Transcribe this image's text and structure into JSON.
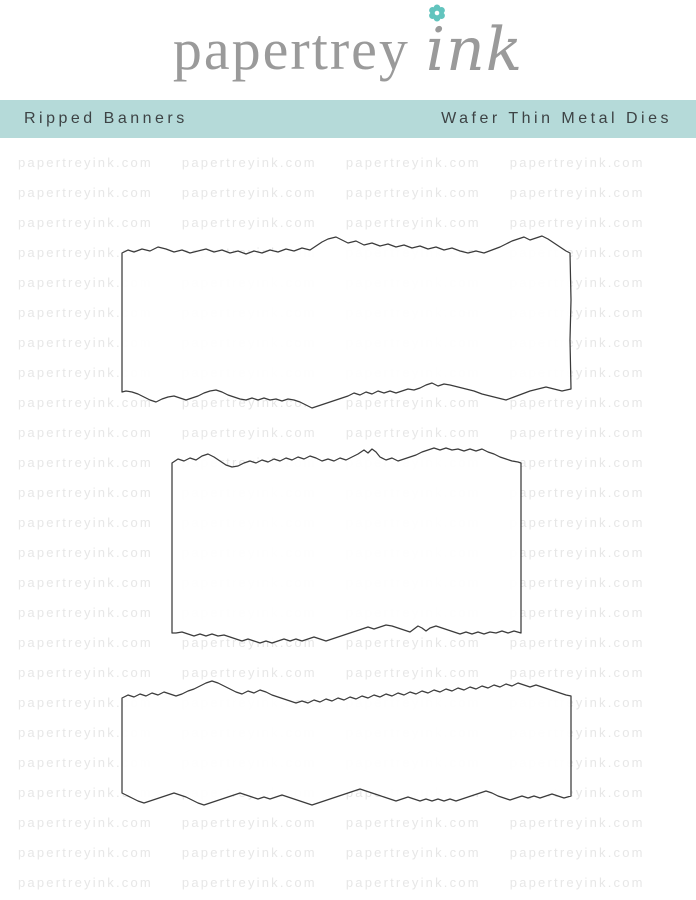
{
  "brand": {
    "name_serif": "papertrey",
    "name_script": "ink"
  },
  "title_bar": {
    "left": "Ripped Banners",
    "right": "Wafer Thin Metal Dies"
  },
  "watermark": {
    "text": "papertreyink.com",
    "repeats_per_row": 4,
    "rows": 25
  },
  "dies": {
    "count": 3,
    "description": "three ripped-edge banner die outlines"
  },
  "theme": {
    "banner_bg": "#b5dad9",
    "banner_text": "#3d4345",
    "logo_gray": "#9a9a9a",
    "flower_teal": "#62c4be",
    "watermark_gray": "#e7e7e7",
    "die_outline": "#3a3a3a"
  }
}
